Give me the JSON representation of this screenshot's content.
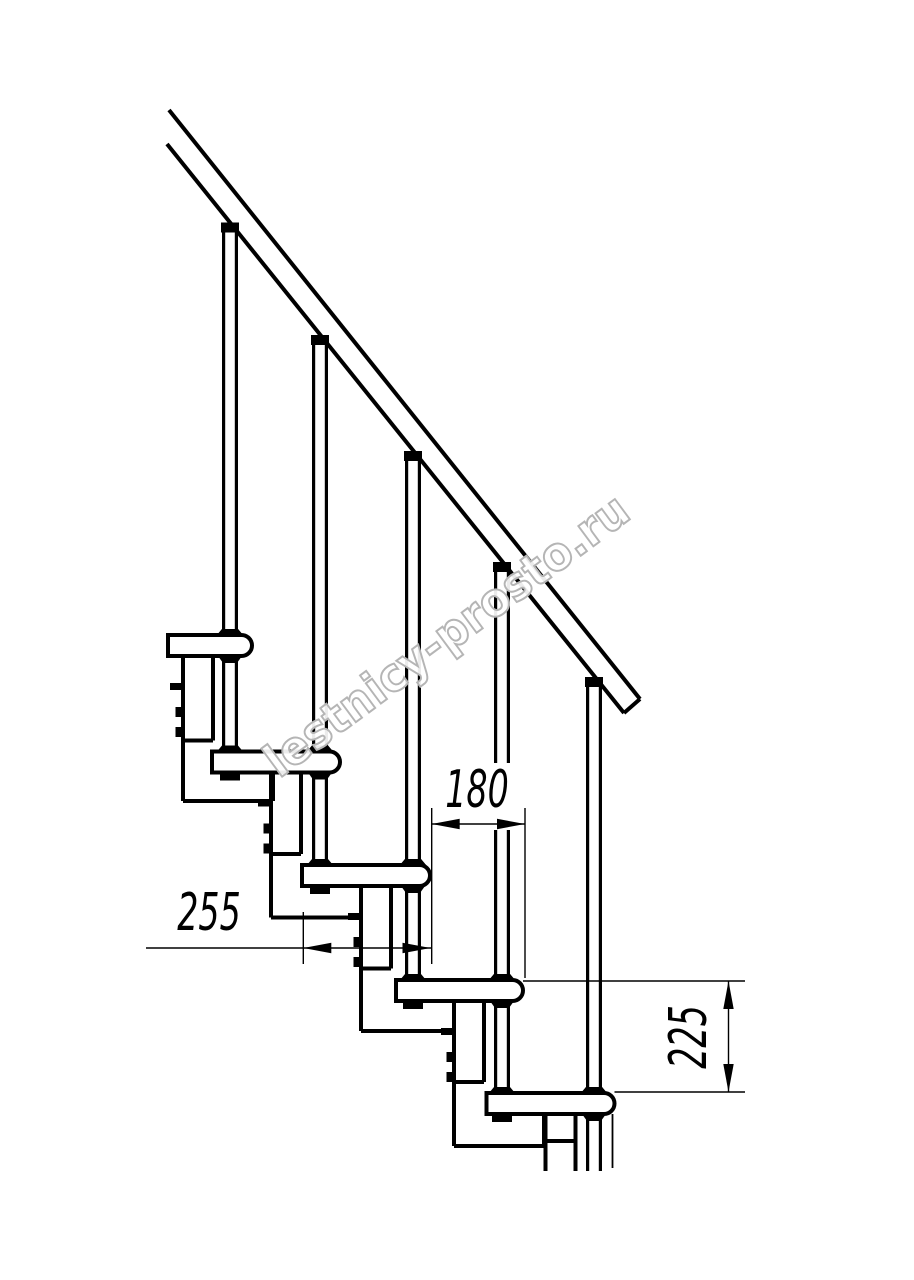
{
  "diagram": {
    "type": "technical-drawing",
    "subject": "Side section of a modular staircase: five treads with rounded noses, support modules with bolt fixings, balusters and an inclined handrail",
    "units": "mm",
    "colors": {
      "line": "#000000",
      "background": "#ffffff",
      "watermark": "#b5b5b5"
    },
    "counts": {
      "steps": 5,
      "balusters": 5,
      "support_modules": 5
    },
    "dimensions": [
      {
        "id": "step-run",
        "value": "180",
        "orientation": "horizontal",
        "measures": "horizontal offset between tread noses"
      },
      {
        "id": "tread-depth",
        "value": "255",
        "orientation": "horizontal",
        "measures": "full tread depth"
      },
      {
        "id": "step-rise",
        "value": "225",
        "orientation": "vertical",
        "measures": "rise between consecutive treads"
      }
    ],
    "watermark": {
      "text": "lestnicy-prosto.ru",
      "color": "#b5b5b5",
      "angle_deg": -36.5
    }
  }
}
